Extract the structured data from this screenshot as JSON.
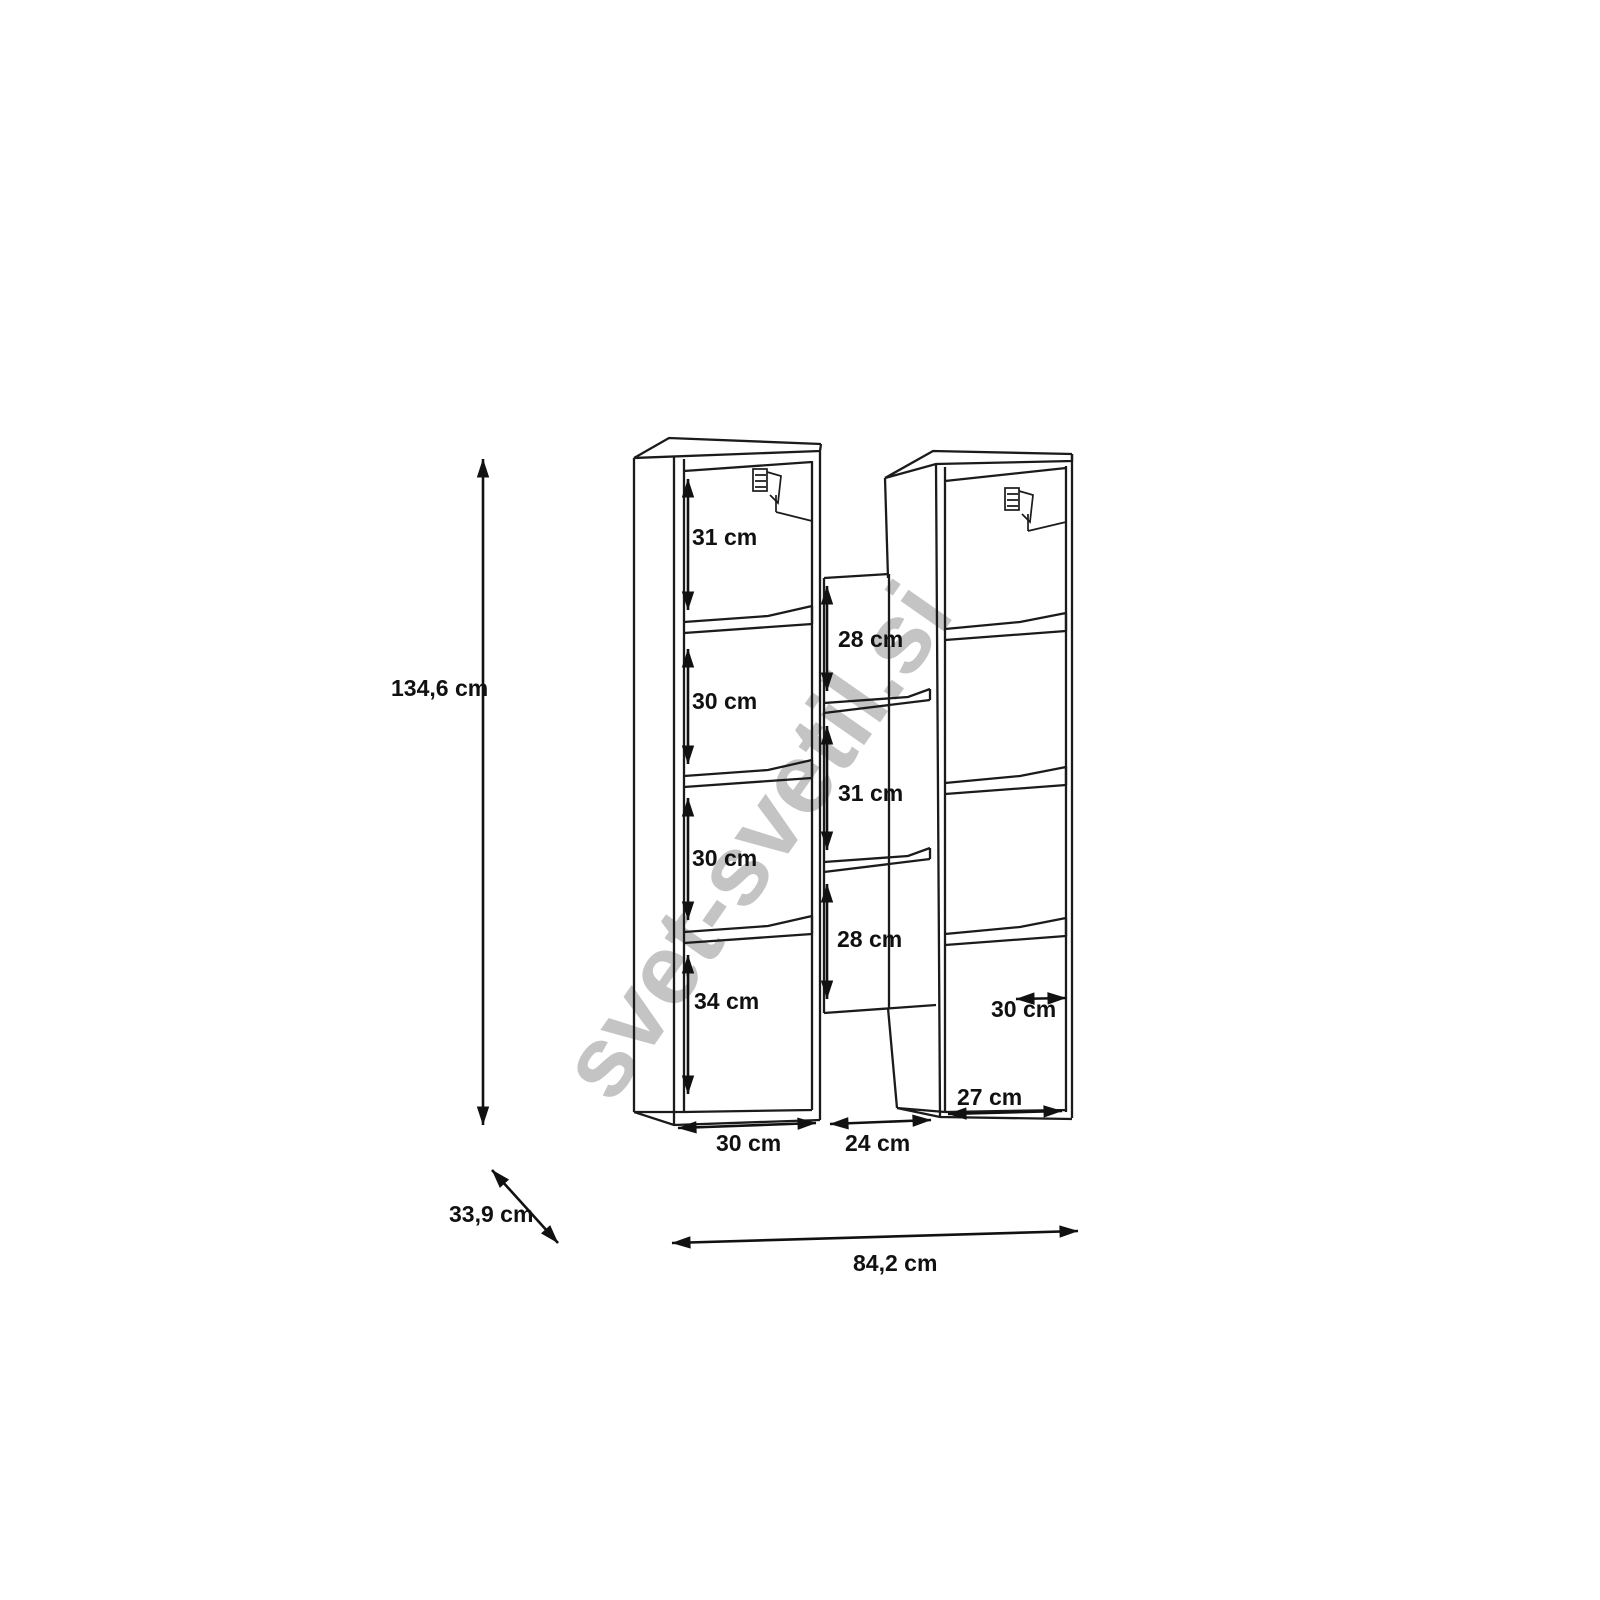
{
  "style": {
    "background": "#ffffff",
    "line_color": "#1b1b1b",
    "text_color": "#111111",
    "watermark_color": "#c4c4c4"
  },
  "watermark": {
    "text": "svet-svetil.si"
  },
  "diagram": {
    "type": "furniture-dimension-drawing",
    "subject": "two-column wall shelf unit with middle shelf section",
    "dims": {
      "height_total": "134,6 cm",
      "depth_total": "33,9 cm",
      "width_total": "84,2 cm",
      "left_column": {
        "compartment_1": "31 cm",
        "compartment_2": "30 cm",
        "compartment_3": "30 cm",
        "compartment_4": "34 cm",
        "width": "30 cm"
      },
      "middle_column": {
        "compartment_1": "28 cm",
        "compartment_2": "31 cm",
        "compartment_3": "28 cm",
        "width": "24 cm"
      },
      "right_column": {
        "shelf_width": "30 cm",
        "bottom_width": "27 cm"
      }
    }
  }
}
